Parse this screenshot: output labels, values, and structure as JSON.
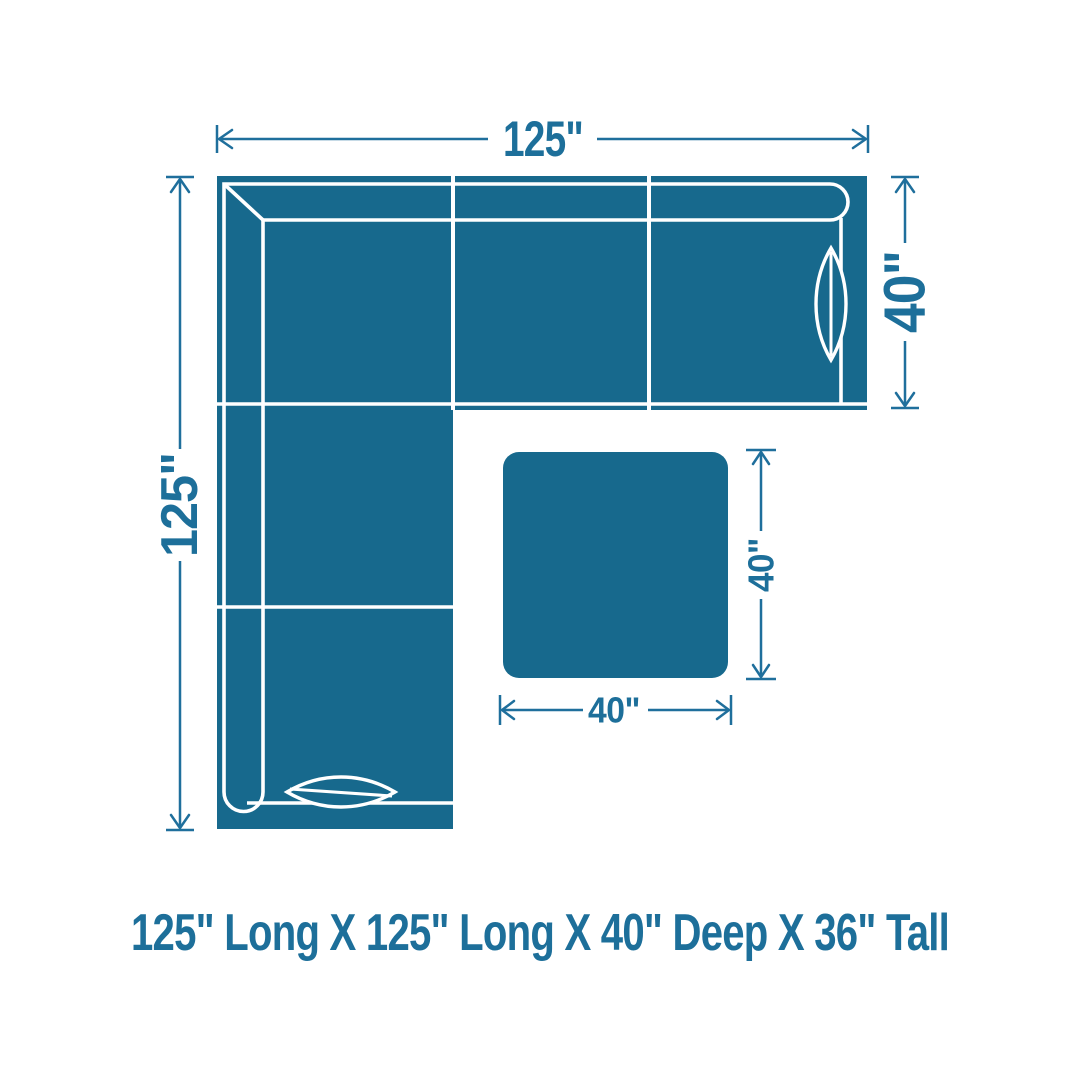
{
  "diagram_meta": {
    "type": "furniture-dimension-diagram",
    "view": "top-down-floor-plan",
    "pieces": [
      "l-shaped-sectional-sofa",
      "square-ottoman"
    ]
  },
  "colors": {
    "background": "#ffffff",
    "furniture_fill": "#17698d",
    "furniture_outline": "#ffffff",
    "dimension_lines": "#1f6f9c",
    "label_text": "#1d6f9a"
  },
  "sofa": {
    "width_label": "125\"",
    "length_label": "125\"",
    "depth_label": "40\""
  },
  "ottoman": {
    "depth_label": "40\"",
    "width_label": "40\""
  },
  "caption": "125\" Long X 125\" Long X 40\" Deep X 36\" Tall"
}
